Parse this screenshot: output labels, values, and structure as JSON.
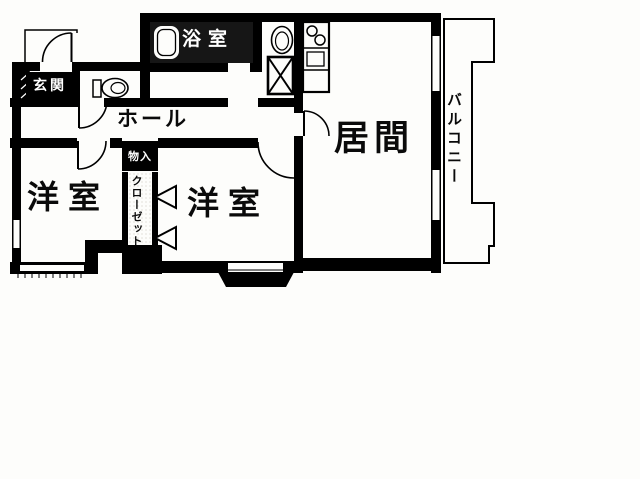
{
  "plan": {
    "labels": {
      "entrance": "玄関",
      "bathroom": "浴室",
      "hall": "ホール",
      "western_room_left": "洋室",
      "western_room_right": "洋室",
      "living_room": "居間",
      "balcony": "バルコニー",
      "closet": "クローゼット",
      "storage": "物入"
    },
    "colors": {
      "line": "#000000",
      "paper": "#fdfdfb",
      "label_box_bg": "#000000",
      "label_box_text": "#ffffff"
    }
  }
}
